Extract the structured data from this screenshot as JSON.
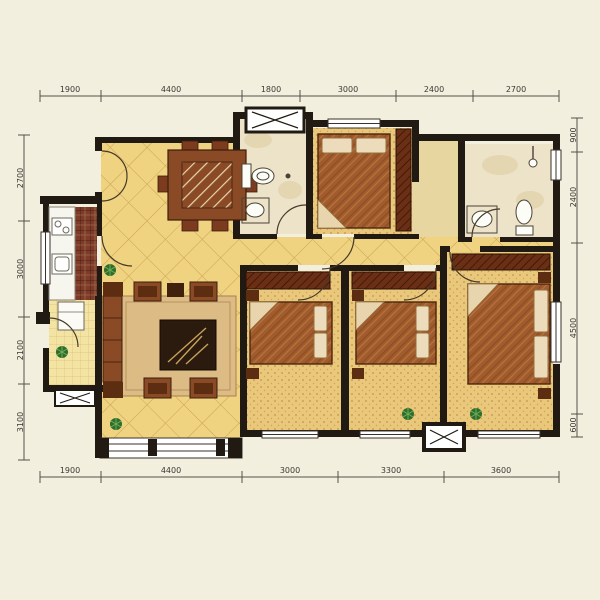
{
  "page": {
    "type": "apartment-floor-plan",
    "units": "mm"
  },
  "dimensions": {
    "top": [
      "1900",
      "4400",
      "1800",
      "3000",
      "2400",
      "2700"
    ],
    "bottom": [
      "1900",
      "4400",
      "3000",
      "3300",
      "3600"
    ],
    "left": [
      "2700",
      "3000",
      "2100",
      "3100"
    ],
    "right": [
      "900",
      "2400",
      "4500",
      "600"
    ]
  },
  "colors": {
    "background": "#f3efdf",
    "wall": "#211a12",
    "tile_yellow": "#efd381",
    "tile_line": "#c9a255",
    "bedroom_floor": "#e9c87b",
    "kitchen_tile": "#7e3c28",
    "bathroom_floor": "#ece3c9",
    "foyer_marble": "#e8d6a0",
    "furniture_brown": "#8a4a26",
    "furniture_dark": "#5d2d12",
    "rug": "#dcbb85",
    "pillow": "#ecdcbb",
    "plant_green": "#2f6d2c",
    "dim_line": "#55504a"
  },
  "icons": [
    "dining-table-icon",
    "chair-icon",
    "sofa-icon",
    "coffee-table-icon",
    "rug-icon",
    "bed-icon",
    "pillow-icon",
    "wardrobe-icon",
    "nightstand-icon",
    "toilet-icon",
    "sink-icon",
    "shower-icon",
    "stove-icon",
    "kitchen-sink-icon",
    "fridge-icon",
    "plant-icon",
    "window-icon",
    "door-arc-icon",
    "ac-platform-icon"
  ]
}
